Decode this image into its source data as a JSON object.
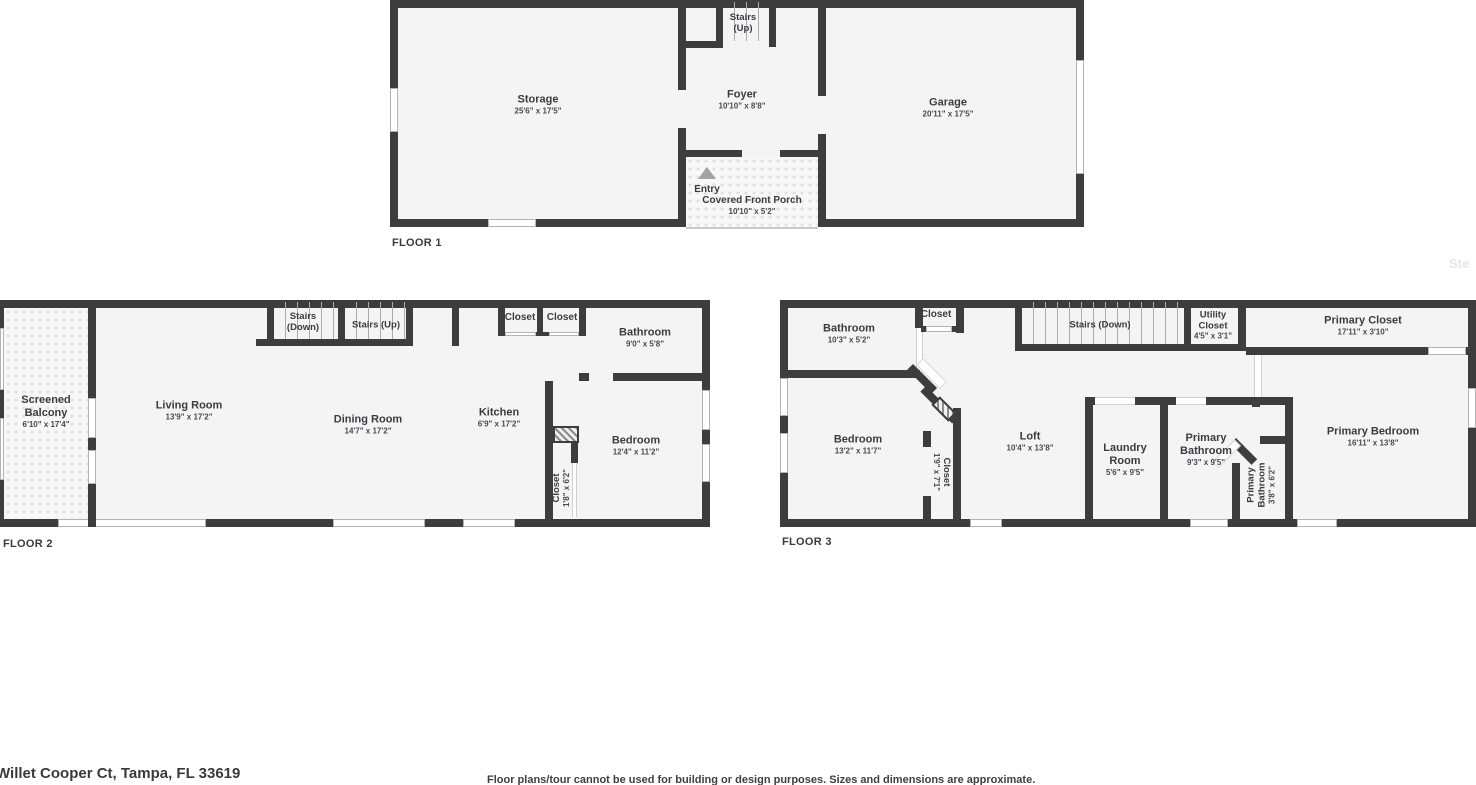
{
  "floor1": {
    "label": "FLOOR 1",
    "storage": {
      "name": "Storage",
      "dims": "25'6\" x 17'5\""
    },
    "stairs_up": {
      "name": "Stairs (Up)"
    },
    "foyer": {
      "name": "Foyer",
      "dims": "10'10\" x 8'8\""
    },
    "garage": {
      "name": "Garage",
      "dims": "20'11\" x 17'5\""
    },
    "entry": {
      "name": "Entry"
    },
    "porch": {
      "name": "Covered Front Porch",
      "dims": "10'10\" x 5'2\""
    }
  },
  "floor2": {
    "label": "FLOOR 2",
    "balcony": {
      "name": "Screened Balcony",
      "dims": "6'10\" x 17'4\""
    },
    "living": {
      "name": "Living Room",
      "dims": "13'9\" x 17'2\""
    },
    "stairs_down": {
      "name": "Stairs (Down)"
    },
    "stairs_up": {
      "name": "Stairs (Up)"
    },
    "closet1": {
      "name": "Closet"
    },
    "closet2": {
      "name": "Closet"
    },
    "bathroom": {
      "name": "Bathroom",
      "dims": "9'0\" x 5'8\""
    },
    "dining": {
      "name": "Dining Room",
      "dims": "14'7\" x 17'2\""
    },
    "kitchen": {
      "name": "Kitchen",
      "dims": "6'9\" x 17'2\""
    },
    "closet3": {
      "name": "Closet",
      "dims": "1'8\" x 6'2\""
    },
    "bedroom": {
      "name": "Bedroom",
      "dims": "12'4\" x 11'2\""
    }
  },
  "floor3": {
    "label": "FLOOR 3",
    "bathroom": {
      "name": "Bathroom",
      "dims": "10'3\" x 5'2\""
    },
    "closet1": {
      "name": "Closet"
    },
    "stairs_down": {
      "name": "Stairs (Down)"
    },
    "utility": {
      "name": "Utility Closet",
      "dims": "4'5\" x 3'1\""
    },
    "primary_closet": {
      "name": "Primary Closet",
      "dims": "17'11\" x 3'10\""
    },
    "bedroom": {
      "name": "Bedroom",
      "dims": "13'2\" x 11'7\""
    },
    "closet2": {
      "name": "Closet",
      "dims": "1'9\" x 7'1\""
    },
    "loft": {
      "name": "Loft",
      "dims": "10'4\" x 13'8\""
    },
    "laundry": {
      "name": "Laundry Room",
      "dims": "5'6\" x 9'5\""
    },
    "primary_bath": {
      "name": "Primary Bathroom",
      "dims": "9'3\" x 9'5\""
    },
    "primary_bath_small": {
      "name": "Primary Bathroom",
      "dims": "3'8\" x 6'2\""
    },
    "primary_bedroom": {
      "name": "Primary Bedroom",
      "dims": "16'11\" x 13'8\""
    }
  },
  "footer": {
    "address": "Willet Cooper Ct, Tampa, FL 33619",
    "disclaimer": "Floor plans/tour cannot be used for building or design purposes. Sizes and dimensions are approximate."
  },
  "watermark": "Ste"
}
